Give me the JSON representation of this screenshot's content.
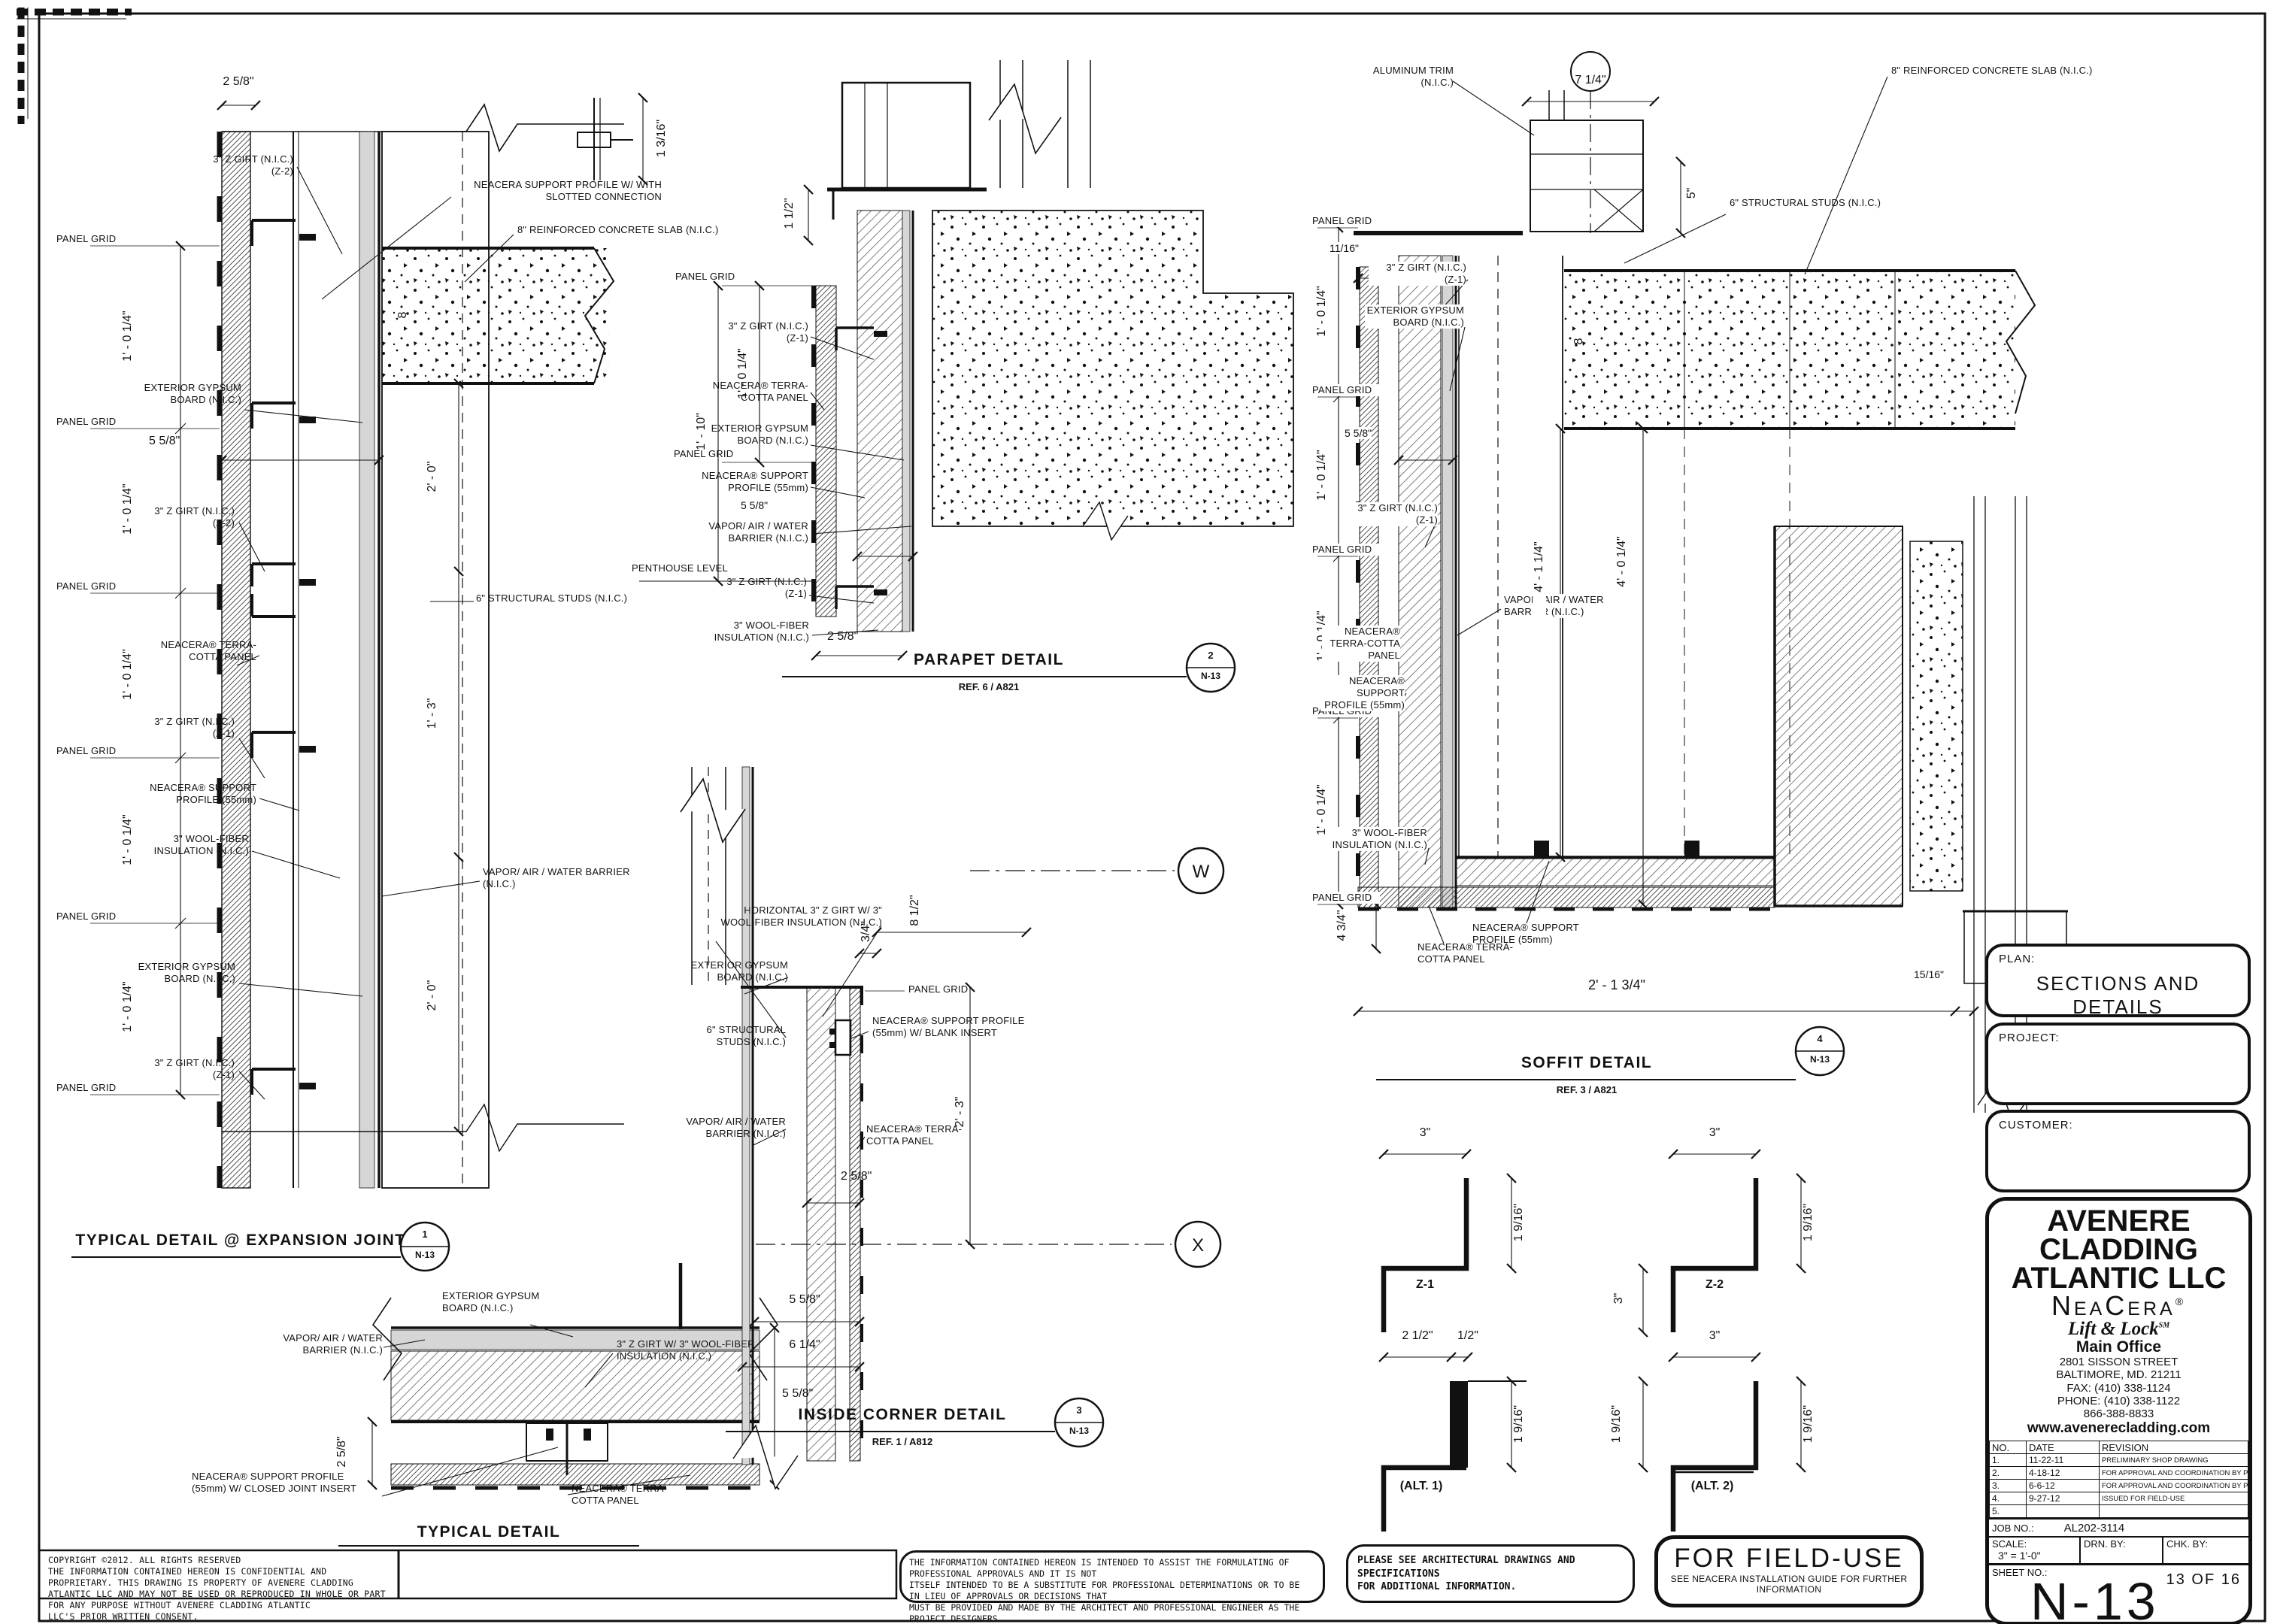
{
  "common": {
    "panel_grid": "PANEL GRID",
    "z_girt": "3\" Z GIRT (N.I.C.)",
    "z1": "(Z-1)",
    "z2": "(Z-2)",
    "ext_gyp": "EXTERIOR GYPSUM BOARD (N.I.C.)",
    "terra": "NEACERA® TERRA-COTTA PANEL",
    "support55": "NEACERA® SUPPORT PROFILE (55mm)",
    "wool": "3\" WOOL-FIBER INSULATION (N.I.C.)",
    "vapor": "VAPOR/ AIR / WATER BARRIER (N.I.C.)",
    "studs": "6\" STRUCTURAL STUDS (N.I.C.)",
    "slab": "8\" REINFORCED CONCRETE SLAB (N.I.C.)",
    "dim_1_0_14": "1' - 0 1/4\"",
    "dim_5_58": "5 5/8\"",
    "dim_2_58": "2 5/8\"",
    "dim_2_0": "2' - 0\"",
    "eight": "8",
    "n13": "N-13"
  },
  "expansion": {
    "title": "TYPICAL DETAIL @ EXPANSION JOINT",
    "num": "1",
    "support_slotted": "NEACERA  SUPPORT PROFILE W/ WITH SLOTTED CONNECTION",
    "dim_1_3": "1' - 3\"",
    "dim_1_316": "1 3/16\""
  },
  "typical": {
    "title": "TYPICAL DETAIL",
    "girt_wool": "3\" Z GIRT W/ 3\" WOOL-FIBER INSULATION (N.I.C.)",
    "support_closed": "NEACERA® SUPPORT PROFILE (55mm) W/ CLOSED JOINT INSERT"
  },
  "parapet": {
    "title": "PARAPET DETAIL",
    "ref": "REF. 6 / A821",
    "num": "2",
    "penthouse": "PENTHOUSE LEVEL",
    "dim_1_12": "1 1/2\"",
    "dim_1_10": "1' - 10\""
  },
  "corner": {
    "title": "INSIDE CORNER DETAIL",
    "ref": "REF. 1 / A812",
    "num": "3",
    "horiz_girt": "HORIZONTAL 3\" Z GIRT W/ 3\" WOOL-FIBER INSULATION (N.I.C.)",
    "support_blank": "NEACERA® SUPPORT PROFILE (55mm) W/ BLANK INSERT",
    "dim_34": "3/4\"",
    "dim_8_12": "8 1/2\"",
    "dim_2_3": "2' - 3\"",
    "dim_6_14": "6 1/4\"",
    "grid_w": "W",
    "grid_x": "X"
  },
  "soffit": {
    "title": "SOFFIT DETAIL",
    "ref": "REF. 3 / A821",
    "num": "4",
    "alum": "ALUMINUM TRIM (N.I.C.)",
    "dim_7_14": "7 1/4\"",
    "dim_5": "5\"",
    "dim_1116": "11/16\"",
    "dim_4_1_14": "4' - 1 1/4\"",
    "dim_4_0_14": "4' - 0 1/4\"",
    "dim_4_34": "4 3/4\"",
    "dim_1516": "15/16\"",
    "dim_2_1_34": "2' - 1 3/4\""
  },
  "profiles": {
    "z1": {
      "name": "Z-1",
      "top": "3\"",
      "side": "1 9/16\""
    },
    "z2": {
      "name": "Z-2",
      "top": "3\"",
      "left": "3\"",
      "side": "1 9/16\""
    },
    "alt1": {
      "name": "(ALT. 1)",
      "top1": "2 1/2\"",
      "top2": "1/2\"",
      "side": "1 9/16\""
    },
    "alt2": {
      "name": "(ALT. 2)",
      "top": "3\"",
      "left": "1 9/16\"",
      "side": "1 9/16\""
    }
  },
  "titleblock": {
    "plan_label": "PLAN:",
    "plan": "SECTIONS AND DETAILS",
    "project_label": "PROJECT:",
    "customer_label": "CUSTOMER:",
    "company_1": "AVENERE",
    "company_2": "CLADDING",
    "company_3": "ATLANTIC LLC",
    "brand": "NeaCera",
    "brand_reg": "®",
    "tagline": "Lift & Lock",
    "tagline_sm": "SM",
    "office": "Main Office",
    "addr_1": "2801 SISSON STREET",
    "addr_2": "BALTIMORE, MD. 21211",
    "fax": "FAX: (410) 338-1124",
    "phone": "PHONE: (410) 338-1122",
    "tollfree": "866-388-8833",
    "web": "www.avenerecladding.com",
    "rev_headers": [
      "NO.",
      "DATE",
      "REVISION"
    ],
    "revisions": [
      {
        "no": "1.",
        "date": "11-22-11",
        "desc": "PRELIMINARY SHOP DRAWING"
      },
      {
        "no": "2.",
        "date": "4-18-12",
        "desc": "FOR APPROVAL AND COORDINATION BY PURCHASER"
      },
      {
        "no": "3.",
        "date": "6-6-12",
        "desc": "FOR APPROVAL AND COORDINATION BY PURCHASER"
      },
      {
        "no": "4.",
        "date": "9-27-12",
        "desc": "ISSUED FOR FIELD-USE"
      },
      {
        "no": "5.",
        "date": "",
        "desc": ""
      }
    ],
    "job_label": "JOB NO.:",
    "job": "AL202-3114",
    "scale_label": "SCALE:",
    "scale": "3\" = 1'-0\"",
    "drn_label": "DRN. BY:",
    "chk_label": "CHK. BY:",
    "sheet_label": "SHEET NO.:",
    "sheet": "N-13",
    "pages": "13 OF 16"
  },
  "notes": {
    "copyright": "COPYRIGHT ©2012. ALL RIGHTS RESERVED\nTHE INFORMATION CONTAINED HEREON IS CONFIDENTIAL AND PROPRIETARY. THIS DRAWING IS PROPERTY OF AVENERE CLADDING\nATLANTIC LLC AND MAY NOT BE USED OR REPRODUCED IN WHOLE OR PART FOR ANY PURPOSE WITHOUT AVENERE CLADDING ATLANTIC\nLLC'S PRIOR WRITTEN CONSENT.",
    "intended": "THE INFORMATION CONTAINED HEREON IS INTENDED TO ASSIST THE FORMULATING OF PROFESSIONAL APPROVALS AND IT IS NOT\nITSELF INTENDED TO BE A SUBSTITUTE FOR PROFESSIONAL DETERMINATIONS OR TO BE IN LIEU OF APPROVALS OR DECISIONS THAT\nMUST BE PROVIDED AND MADE BY THE ARCHITECT AND PROFESSIONAL ENGINEER AS THE PROJECT DESIGNERS.",
    "see_arch": "PLEASE SEE ARCHITECTURAL DRAWINGS AND SPECIFICATIONS\nFOR ADDITIONAL INFORMATION.",
    "field_use": "FOR FIELD-USE",
    "field_use_sub": "SEE NEACERA INSTALLATION GUIDE FOR FURTHER INFORMATION"
  }
}
